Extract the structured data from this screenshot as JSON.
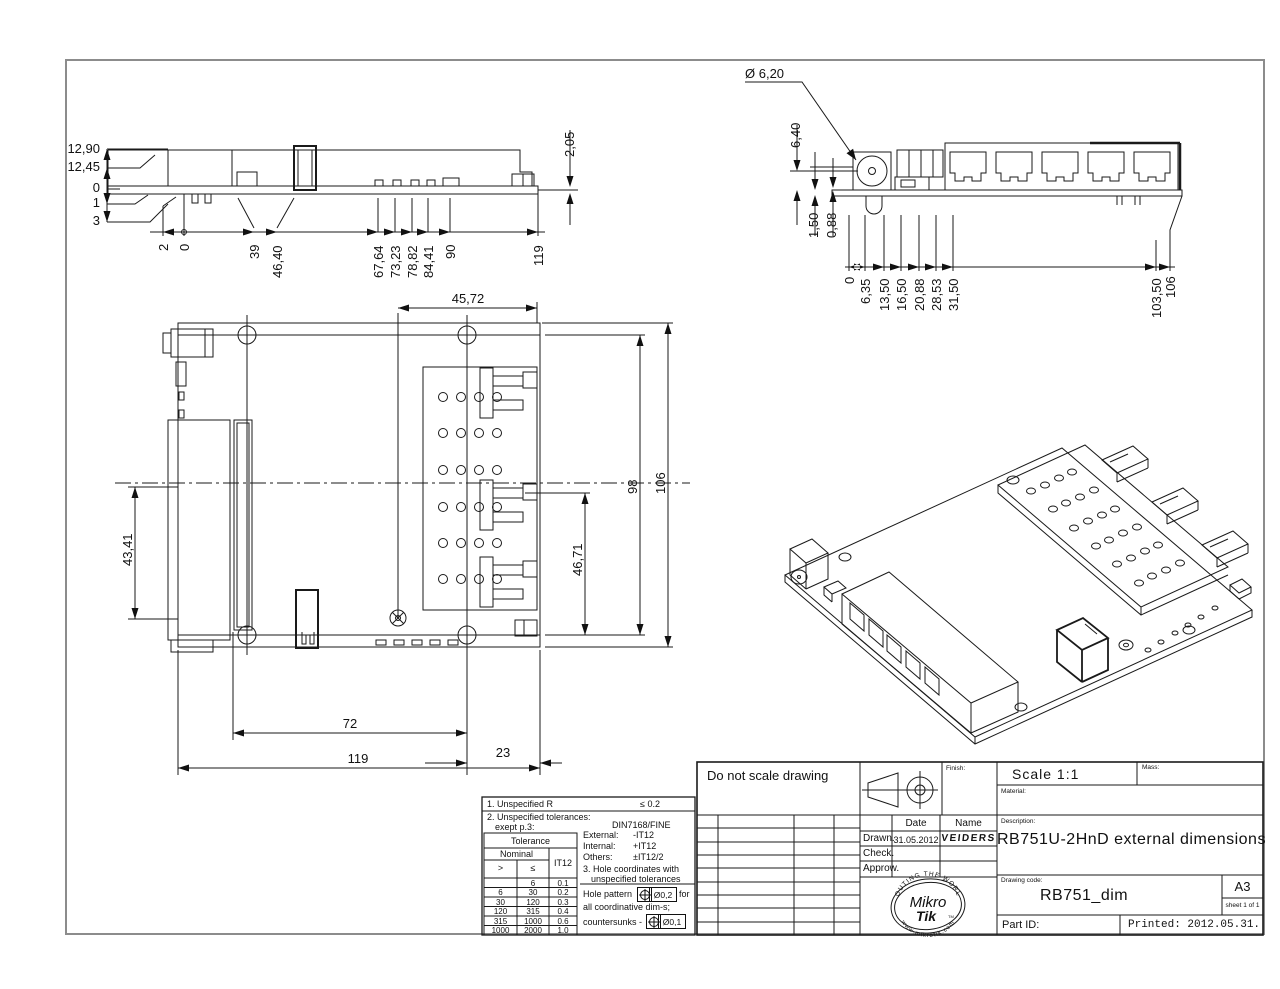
{
  "views": {
    "side": {
      "left_dims": [
        "12,90",
        "12,45",
        "0",
        "1",
        "3"
      ],
      "bottom_dims": [
        "2",
        "0",
        "39",
        "46,40",
        "67,64",
        "73,23",
        "78,82",
        "84,41",
        "90",
        "119"
      ],
      "right_dim": "2,05"
    },
    "front": {
      "diameter_callout": "Ø 6,20",
      "upper_dim": "6,40",
      "lower_dims": [
        "1,50",
        "0,88"
      ],
      "bottom_dims": [
        "0",
        "6,35",
        "13,50",
        "16,50",
        "20,88",
        "28,53",
        "31,50",
        "103,50",
        "106"
      ]
    },
    "plan": {
      "top_dim": "45,72",
      "left_dim": "43,41",
      "inner_dim": "46,71",
      "right_dim_inner": "98",
      "right_dim_outer": "106",
      "bottom_dim_1": "72",
      "bottom_dim_2": "119",
      "bottom_dim_3": "23"
    }
  },
  "notes": {
    "line1_label": "1. Unspecified R",
    "line1_value": "≤  0.2",
    "line2a": "2. Unspecified tolerances:",
    "line2b": "exept p.3:",
    "line2_value": "DIN7168/FINE",
    "tol_table": {
      "title": "Tolerance",
      "nominal": "Nominal",
      "col_gt": ">",
      "col_le": "≤",
      "col_it": "IT12",
      "rows": [
        [
          "",
          "6",
          "0.1"
        ],
        [
          "6",
          "30",
          "0.2"
        ],
        [
          "30",
          "120",
          "0.3"
        ],
        [
          "120",
          "315",
          "0.4"
        ],
        [
          "315",
          "1000",
          "0.6"
        ],
        [
          "1000",
          "2000",
          "1.0"
        ]
      ]
    },
    "external_label": "External:",
    "external_value": "-IT12",
    "internal_label": "Internal:",
    "internal_value": "+IT12",
    "others_label": "Others:",
    "others_value": "±IT12/2",
    "line3a": "3. Hole coordinates with",
    "line3b": "unspecified tolerances",
    "hole_pattern_pre": "Hole pattern",
    "hole_pattern_val": "Ø0,2",
    "hole_pattern_post": "for",
    "hole_pattern_line2": "all coordinative dim-s;",
    "countersunk_pre": "countersunks -",
    "countersunk_val": "Ø0,1"
  },
  "title_block": {
    "do_not_scale": "Do not scale drawing",
    "finish_label": "Finish:",
    "date_header": "Date",
    "name_header": "Name",
    "drawn_label": "Drawn.",
    "drawn_date": "31.05.2012",
    "drawn_name": "VEIDERS",
    "check_label": "Check.",
    "approve_label": "Approw.",
    "scale_label": "Scale  1:1",
    "mass_label": "Mass:",
    "material_label": "Material:",
    "description_label": "Description:",
    "description": "RB751U-2HnD external dimensions",
    "drawing_code_label": "Drawing code:",
    "drawing_code": "RB751_dim",
    "paper_size": "A3",
    "sheet": "sheet 1 of 1",
    "part_id_label": "Part ID:",
    "printed": "Printed: 2012.05.31."
  },
  "logo": {
    "arc_top": "ROUTING THE WORLD",
    "name_line1": "Mikro",
    "name_line2": "Tik",
    "tm": "TM",
    "arc_bottom": "www.mikrotik.com"
  },
  "colors": {
    "line": "#1a1a1a",
    "frame": "#8c8c8c",
    "background": "#ffffff"
  }
}
